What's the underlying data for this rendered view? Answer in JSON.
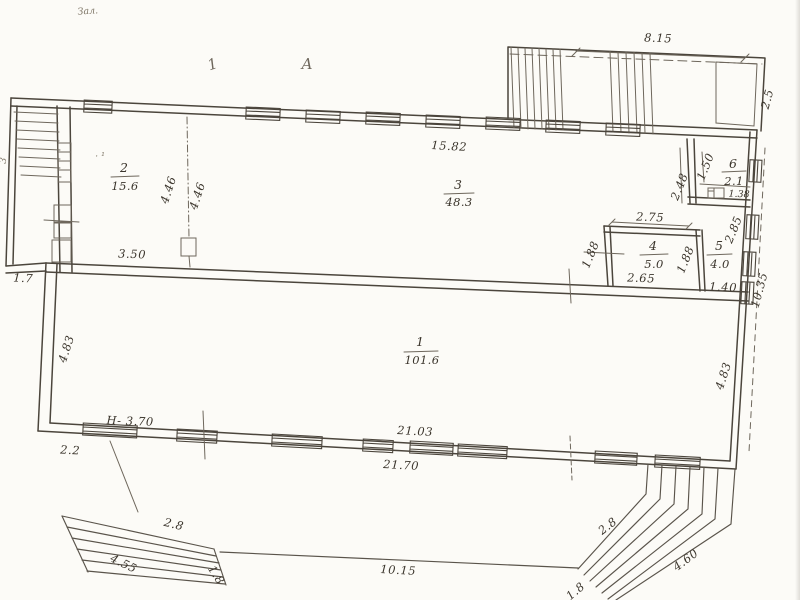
{
  "scan": {
    "note": "Зал.",
    "edge_mark": "3",
    "stray_mark": "· ¹",
    "axis_tick": "1",
    "axis_letter": "А"
  },
  "rooms": {
    "r1": {
      "num": "1",
      "area": "101.6"
    },
    "r2": {
      "num": "2",
      "area": "15.6"
    },
    "r3": {
      "num": "3",
      "area": "48.3"
    },
    "r4": {
      "num": "4",
      "area": "5.0"
    },
    "r5": {
      "num": "5",
      "area": "4.0"
    },
    "r6": {
      "num": "6",
      "area": "2.1"
    }
  },
  "dims": {
    "porch_top": "8.15",
    "porch_side": "2.5",
    "wall_top": "15.82",
    "part_a": "4.46",
    "part_b": "4.46",
    "room2_w": "3.50",
    "vest": "1.7",
    "w248": "2.48",
    "w150": "1.50",
    "wc": "1.38",
    "r4_top": "2.75",
    "r4_bot": "2.65",
    "r4_l": "1.88",
    "r4_r": "1.88",
    "r5_h": "2.85",
    "r5_w": "1.40",
    "right_wall": "10.35",
    "r1_l": "4.83",
    "r1_r": "4.83",
    "height": "H- 3.70",
    "corner": "2.2",
    "bot_in": "21.03",
    "bot_out": "21.70",
    "front": "10.15",
    "sl_top": "2.8",
    "sl_side": "4.55",
    "sl_edge": "1.8",
    "sr_top": "2.8",
    "sr_side": "4.60",
    "sr_edge": "1.8"
  }
}
